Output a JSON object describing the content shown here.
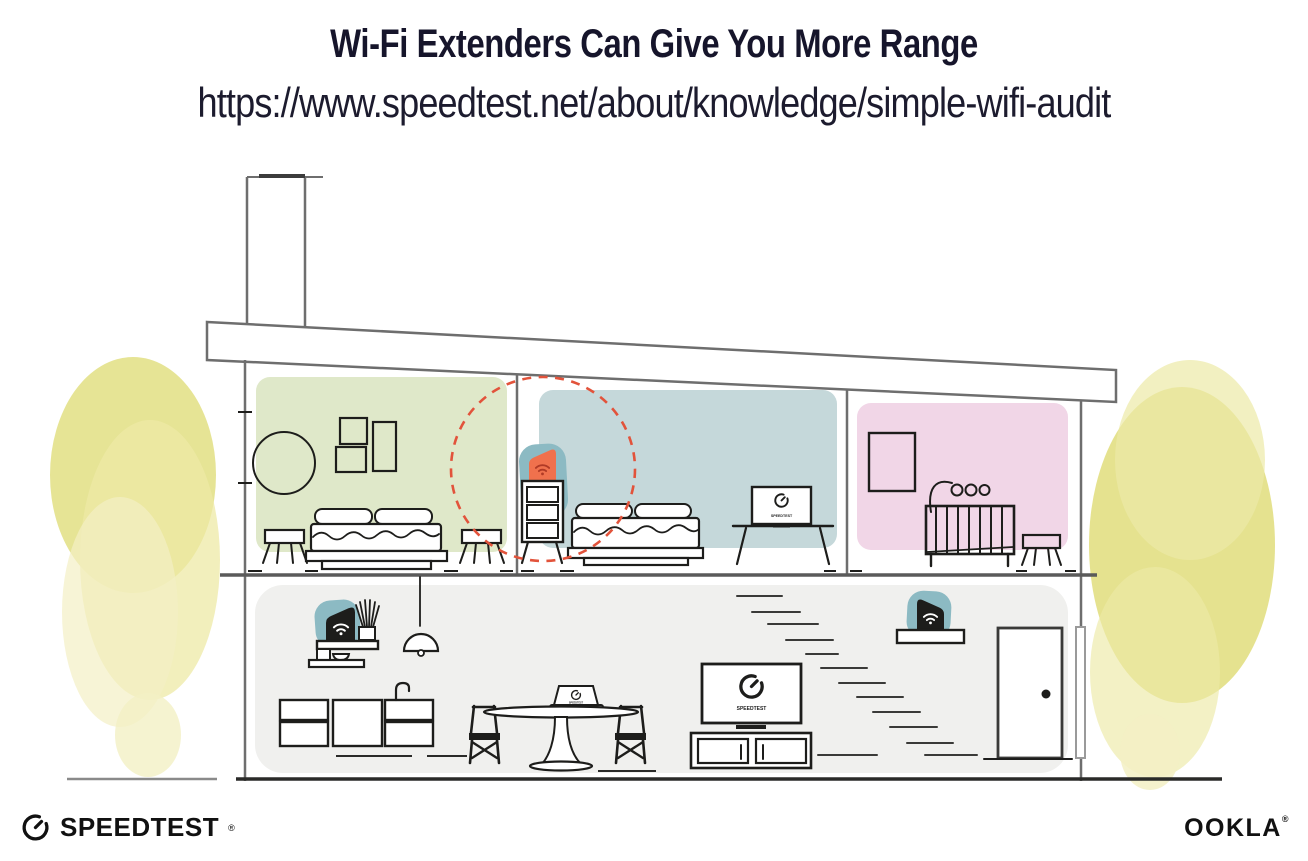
{
  "header": {
    "title": "Wi-Fi Extenders Can Give You More Range",
    "url": "https://www.speedtest.net/about/knowledge/simple-wifi-audit"
  },
  "branding": {
    "speedtest_label": "SPEEDTEST",
    "speedtest_reg_mark": "®",
    "speedtest_icon": "speedtest-gauge-icon",
    "ookla_label": "OOKLA",
    "ookla_reg_mark": "®"
  },
  "screens": {
    "tv_bedroom_label": "SPEEDTEST",
    "laptop_label": "SPEEDTEST",
    "tv_living_label": "SPEEDTEST"
  },
  "devices": {
    "extender_bedroom": {
      "icon": "wifi-icon",
      "state": "highlighted-orange"
    },
    "router_kitchen": {
      "icon": "wifi-icon",
      "state": "normal-dark"
    },
    "extender_stairs": {
      "icon": "wifi-icon",
      "state": "normal-dark"
    }
  },
  "colors": {
    "roomGreen": "#dfe8c9",
    "roomBlue": "#c5d8da",
    "roomPink": "#f1d6e7",
    "floorGray": "#f0f0ee",
    "teal": "#8cbac3",
    "orange": "#f0714d",
    "wifiRed": "#b03a26",
    "dash": "#e2533b",
    "treeYellow": "#e0dd7b",
    "treeYellowLight": "#edeaa6",
    "treeYellowPale": "#f3f0c4"
  }
}
